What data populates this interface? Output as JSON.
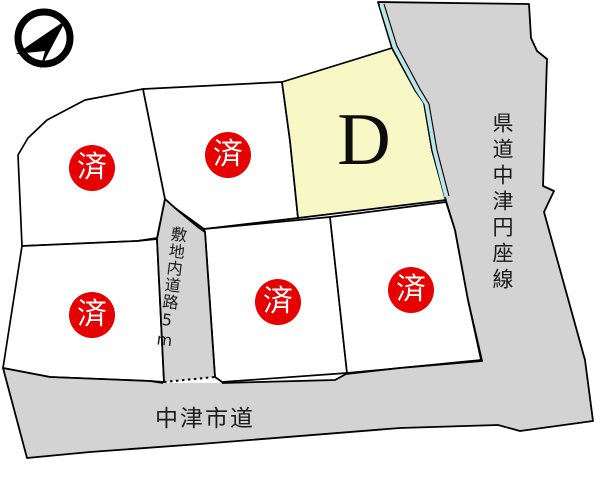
{
  "colors": {
    "road_fill": "#d3d3d3",
    "lot_available_fill": "#f8f7c6",
    "sold_red": "#e60000",
    "waterline_cyan": "#b2e9f0",
    "outline": "#000000"
  },
  "compass": {
    "name": "north-arrow"
  },
  "roads": {
    "prefectural_label": "県道中津円座線",
    "city_label": "中津市道",
    "internal_label": "敷地内道路5m"
  },
  "lots": {
    "available": {
      "label": "D"
    },
    "sold": [
      {
        "status": "済"
      },
      {
        "status": "済"
      },
      {
        "status": "済"
      },
      {
        "status": "済"
      },
      {
        "status": "済"
      }
    ]
  }
}
